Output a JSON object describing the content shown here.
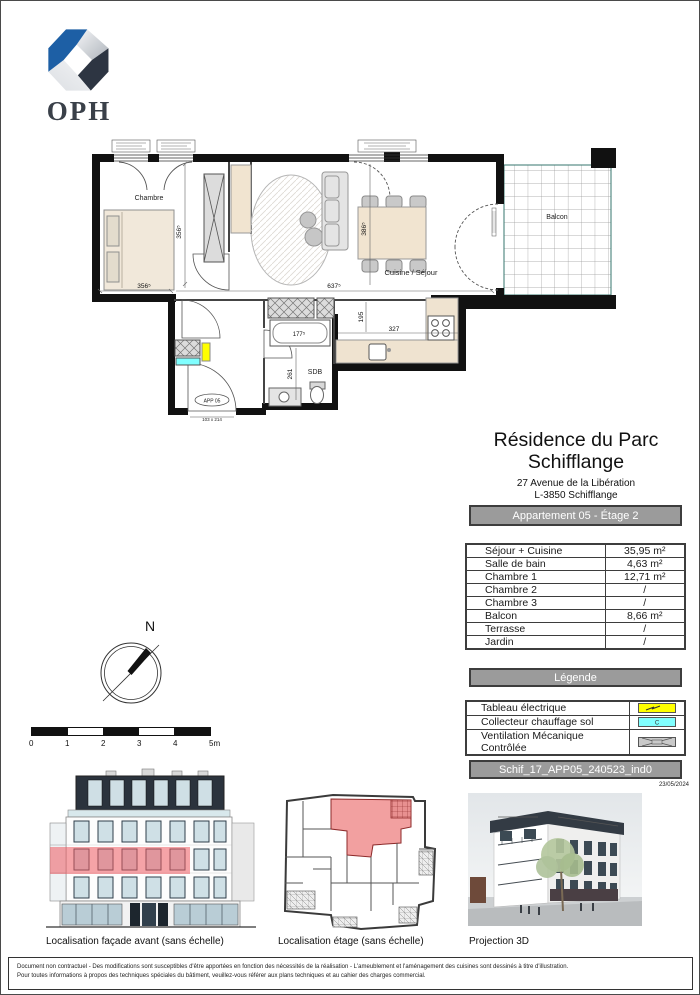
{
  "logo": {
    "text": "OPH"
  },
  "title_block": {
    "title_line1": "Résidence du Parc",
    "title_line2": "Schifflange",
    "address_line1": "27 Avenue de la Libération",
    "address_line2": "L-3850 Schifflange",
    "apartment_badge": "Appartement 05 - Étage 2",
    "reference_badge": "Schif_17_APP05_240523_ind0",
    "date": "23/05/2024"
  },
  "areas_table": {
    "rows": [
      {
        "label": "Séjour + Cuisine",
        "value": "35,95 m²"
      },
      {
        "label": "Salle de bain",
        "value": "4,63 m²"
      },
      {
        "label": "Chambre 1",
        "value": "12,71 m²"
      },
      {
        "label": "Chambre 2",
        "value": "/"
      },
      {
        "label": "Chambre 3",
        "value": "/"
      },
      {
        "label": "Balcon",
        "value": "8,66 m²"
      },
      {
        "label": "Terrasse",
        "value": "/"
      },
      {
        "label": "Jardin",
        "value": "/"
      }
    ]
  },
  "legend": {
    "title": "Légende",
    "items": [
      {
        "label": "Tableau électrique",
        "swatch_color": "#ffff00"
      },
      {
        "label": "Collecteur chauffage sol",
        "swatch_color": "#80ffff",
        "swatch_letter": "C"
      },
      {
        "label": "Ventilation Mécanique Contrôlée",
        "swatch_color": "#c9c9c9"
      }
    ]
  },
  "floor_plan": {
    "rooms": {
      "bedroom": "Chambre",
      "living": "Cuisine / Séjour",
      "bathroom": "SDB",
      "balcony": "Balcon"
    },
    "entry": {
      "label": "APP 05",
      "door_size": "103 x 214"
    },
    "dims": {
      "bedroom_h": "356⁵",
      "bedroom_w": "356⁵",
      "living_w": "637⁵",
      "living_h": "386⁵",
      "bathtub": "177⁵",
      "kitchen_depth": "195",
      "kitchen_w": "327",
      "bathroom_h": "261"
    },
    "colors": {
      "electric": "#ffff00",
      "collector": "#80ffff",
      "highlight": "#f08080"
    }
  },
  "compass": {
    "north": "N"
  },
  "scale": {
    "ticks": [
      "0",
      "1",
      "2",
      "3",
      "4",
      "5m"
    ]
  },
  "captions": {
    "facade": "Localisation façade avant (sans échelle)",
    "etage": "Localisation étage (sans échelle)",
    "projection": "Projection 3D"
  },
  "footer": {
    "line1": "Document non contractuel - Des modifications sont susceptibles d'être apportées en fonction des nécessités de la réalisation - L'ameublement et l'aménagement des cuisines sont dessinés à titre d'illustration.",
    "line2": "Pour toutes informations à propos des techniques spéciales du bâtiment, veuillez-vous référer aux plans techniques et au cahier des charges commercial."
  }
}
